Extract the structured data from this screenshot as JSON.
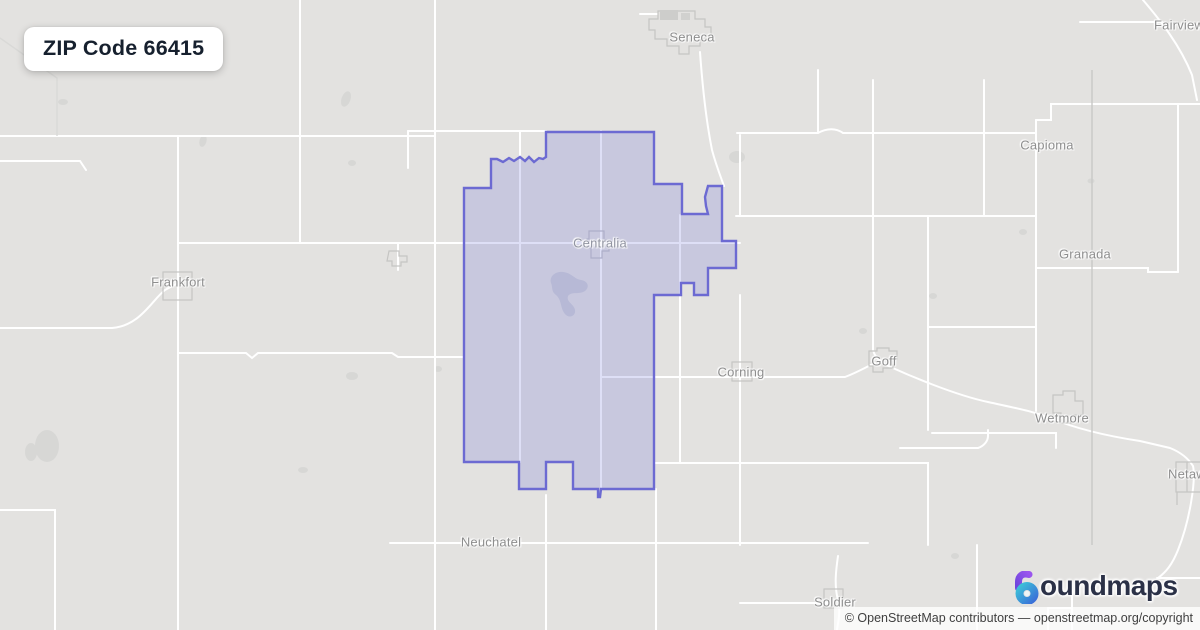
{
  "badge": {
    "title": "ZIP Code 66415"
  },
  "map": {
    "labels": {
      "seneca": "Seneca",
      "fairview": "Fairview",
      "capioma": "Capioma",
      "granada": "Granada",
      "frankfort": "Frankfort",
      "centralia": "Centralia",
      "corning": "Corning",
      "goff": "Goff",
      "wetmore": "Wetmore",
      "netawaka": "Netawaka",
      "neuchatel": "Neuchatel",
      "soldier": "Soldier"
    },
    "zip_boundary": {
      "zip_code": "66415"
    }
  },
  "branding": {
    "brand_name": "boundmaps",
    "logo_text": "oundmaps"
  },
  "attribution": {
    "text": "© OpenStreetMap contributors — openstreetmap.org/copyright"
  },
  "colors": {
    "map_background": "#e3e2e0",
    "road": "#ffffff",
    "boundary_stroke": "#6c6ad2",
    "boundary_fill": "rgba(105,110,215,0.22)",
    "label_text": "#8e8e8e",
    "badge_text": "#16202e",
    "logo_navy": "#2b3147",
    "logo_purple": "#8850e8",
    "logo_teal": "#36b3d8",
    "attribution_background": "rgba(255,255,255,0.78)"
  }
}
